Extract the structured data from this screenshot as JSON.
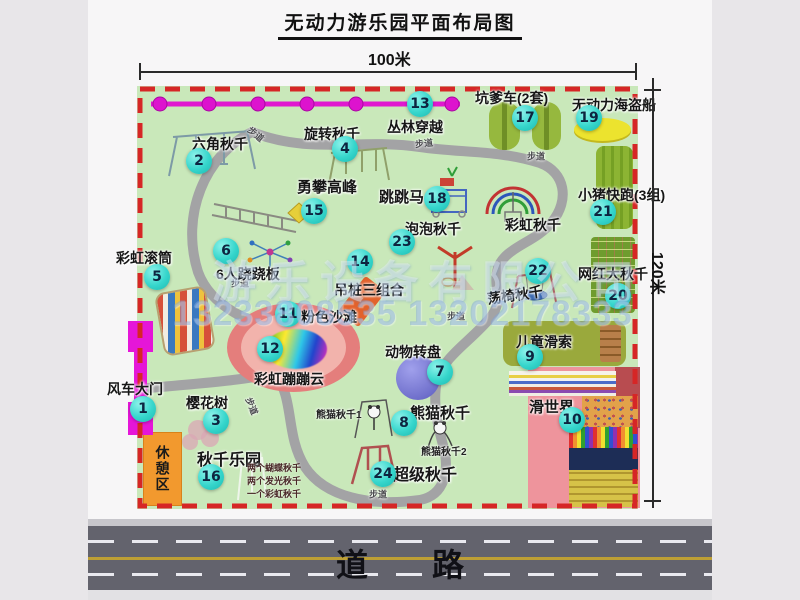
{
  "title": "无动力游乐园平面布局图",
  "dim_w": "100米",
  "dim_h": "120米",
  "road": "道路",
  "wm_co": "游乐设备有限公司",
  "wm_ph": "13233808535 13202178333",
  "rest": "休憩区",
  "trail": "步道",
  "rainbow": "彩虹秋千",
  "colors": {
    "map_bg": "#c9e8ba",
    "border_dash": "#d62626",
    "number_badge": "#36d6cc",
    "zipline": "#e018d0",
    "road": "#63636d",
    "trail": "#a3a3a5",
    "rest_area": "#f2992e"
  },
  "attractions": [
    {
      "num": "1",
      "label": "风车大门"
    },
    {
      "num": "2",
      "label": "六角秋千"
    },
    {
      "num": "3",
      "label": "樱花树"
    },
    {
      "num": "4",
      "label": "旋转秋千"
    },
    {
      "num": "5",
      "label": "彩虹滚筒"
    },
    {
      "num": "6",
      "label": "6人跷跷板"
    },
    {
      "num": "7",
      "label": "动物转盘"
    },
    {
      "num": "8",
      "label": "熊猫秋千",
      "sub1": "熊猫秋千1",
      "sub2": "熊猫秋千2"
    },
    {
      "num": "9",
      "label": "儿童滑索"
    },
    {
      "num": "10",
      "label": "滑世界"
    },
    {
      "num": "11",
      "label": "粉色沙滩"
    },
    {
      "num": "12",
      "label": "彩虹蹦蹦云"
    },
    {
      "num": "13",
      "label": "丛林穿越"
    },
    {
      "num": "14",
      "label": "吊桩三组合"
    },
    {
      "num": "15",
      "label": "勇攀高峰"
    },
    {
      "num": "16",
      "label": "秋千乐园",
      "note1": "两个蝴蝶秋千",
      "note2": "两个发光秋千",
      "note3": "一个彩虹秋千"
    },
    {
      "num": "17",
      "label": "坑爹车(2套)"
    },
    {
      "num": "18",
      "label": "跳跳马"
    },
    {
      "num": "19",
      "label": "无动力海盗船"
    },
    {
      "num": "20",
      "label": "网红大秋千"
    },
    {
      "num": "21",
      "label": "小猪快跑(3组)"
    },
    {
      "num": "22",
      "label": "荡椅秋千"
    },
    {
      "num": "23",
      "label": "泡泡秋千"
    },
    {
      "num": "24",
      "label": "超级秋千"
    }
  ]
}
